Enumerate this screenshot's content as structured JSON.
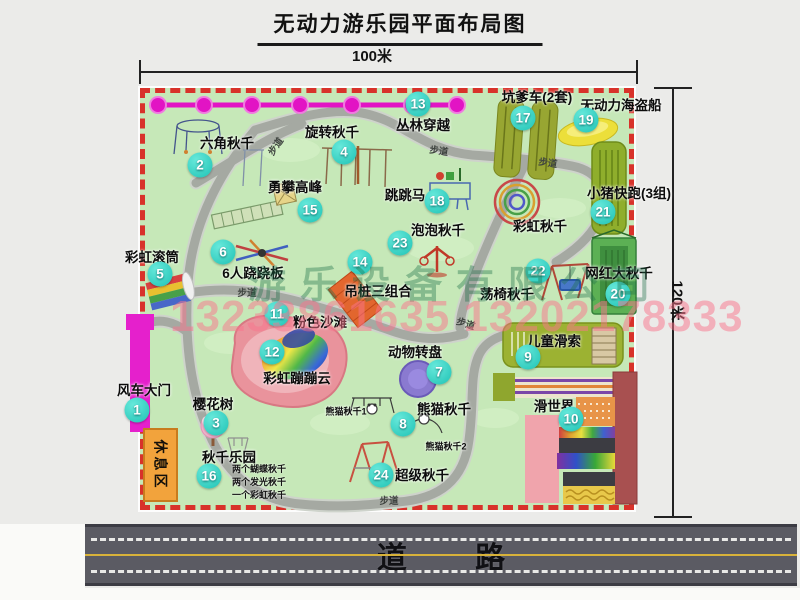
{
  "title": "无动力游乐园平面布局图",
  "dimensions": {
    "width_label": "100米",
    "height_label": "120米"
  },
  "road": {
    "label": "道 路"
  },
  "watermark": {
    "company": "游乐设备有限公司",
    "phone": "13233861635 13202178333"
  },
  "rest_area": {
    "label": "休息区"
  },
  "path_label": "步道",
  "extra_labels": {
    "rainbow_swing": "彩虹秋千",
    "panda_swing_1": "熊猫秋千1",
    "panda_swing_2": "熊猫秋千2"
  },
  "swing_park_notes": [
    "两个蝴蝶秋千",
    "两个发光秋千",
    "一个彩虹秋千"
  ],
  "attractions": [
    {
      "num": "1",
      "label": "风车大门"
    },
    {
      "num": "2",
      "label": "六角秋千"
    },
    {
      "num": "3",
      "label": "樱花树"
    },
    {
      "num": "4",
      "label": "旋转秋千"
    },
    {
      "num": "5",
      "label": "彩虹滚筒"
    },
    {
      "num": "6",
      "label": "6人跷跷板"
    },
    {
      "num": "7",
      "label": "动物转盘"
    },
    {
      "num": "8",
      "label": "熊猫秋千"
    },
    {
      "num": "9",
      "label": "儿童滑索"
    },
    {
      "num": "10",
      "label": "滑世界"
    },
    {
      "num": "11",
      "label": "粉色沙滩"
    },
    {
      "num": "12",
      "label": "彩虹蹦蹦云"
    },
    {
      "num": "13",
      "label": "丛林穿越"
    },
    {
      "num": "14",
      "label": "吊桩三组合"
    },
    {
      "num": "15",
      "label": "勇攀高峰"
    },
    {
      "num": "16",
      "label": "秋千乐园"
    },
    {
      "num": "17",
      "label": "坑爹车(2套)"
    },
    {
      "num": "18",
      "label": "跳跳马"
    },
    {
      "num": "19",
      "label": "无动力海盗船"
    },
    {
      "num": "20",
      "label": "网红大秋千"
    },
    {
      "num": "21",
      "label": "小猪快跑(3组)"
    },
    {
      "num": "22",
      "label": "荡椅秋千"
    },
    {
      "num": "23",
      "label": "泡泡秋千"
    },
    {
      "num": "24",
      "label": "超级秋千"
    }
  ],
  "colors": {
    "park_green": "#c6e8b8",
    "border_red": "#d8322a",
    "marker_teal": "#1fc2b4",
    "zipline_magenta": "#e214c4",
    "road_gray": "#5b5b63"
  }
}
